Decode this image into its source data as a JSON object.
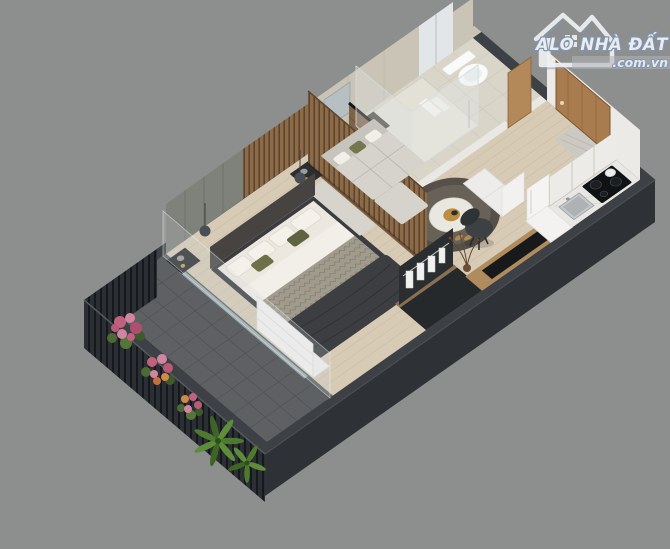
{
  "watermark": {
    "brand": "ALO NHÀ ĐẤT",
    "domain": ".com.vn",
    "icon": "house-logo-icon"
  },
  "scene": {
    "type": "3d-floorplan-render",
    "description": "Isometric 3D cutaway render of a furnished studio apartment",
    "background_color": "#8d8e8e",
    "palette": {
      "wall_top": "#3d4044",
      "wall_face": "#2e3135",
      "floor_wood": "#d7cbb6",
      "balcony_floor": "#5e6063",
      "bathroom_tile": "#d9d5c9",
      "marble_wall": "#cac4b6",
      "door_wood": "#a87c4e",
      "sofa_gray": "#d6d3cc",
      "duvet_dark": "#3c3e41",
      "accent_olive": "#6e7048",
      "flower_pink": "#c0627f",
      "plant_green": "#4e7a2f",
      "logo_blue": "#7e95b8"
    },
    "rooms": [
      {
        "name": "balcony"
      },
      {
        "name": "bedroom"
      },
      {
        "name": "living-area"
      },
      {
        "name": "bathroom"
      },
      {
        "name": "kitchen"
      },
      {
        "name": "entry"
      }
    ],
    "objects": [
      "double-bed",
      "nightstands",
      "pendant-lamps",
      "white-dresser",
      "wood-slat-partition",
      "l-shaped-sofa",
      "round-rug",
      "round-coffee-table",
      "tv-console",
      "desk-chair",
      "open-wardrobe-with-clothes",
      "kitchen-counter",
      "cooktop",
      "kitchen-sink",
      "fridge-cabinet",
      "vanity-double-sink",
      "mirror",
      "glass-shower",
      "toilet",
      "entry-door",
      "bathroom-door",
      "balcony-railing",
      "balcony-flowers",
      "balcony-palms"
    ]
  }
}
